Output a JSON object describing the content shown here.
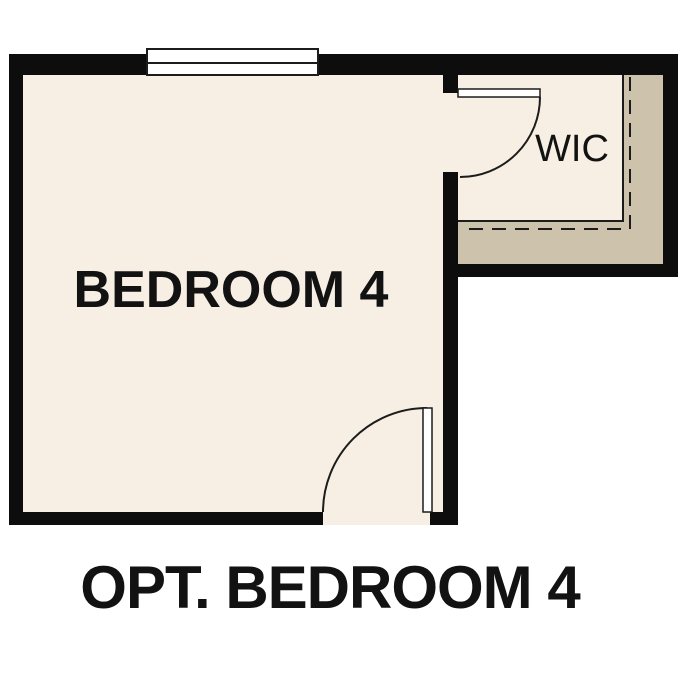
{
  "plan": {
    "bedroom_label": "BEDROOM 4",
    "closet_label": "WIC",
    "caption": "OPT. BEDROOM 4"
  },
  "colors": {
    "background": "#ffffff",
    "wall": "#0d0d0d",
    "floor": "#f7efe3",
    "closet_shading": "#cdc2ab",
    "line": "#1c1c1c",
    "window_fill": "#ffffff",
    "text": "#121212"
  }
}
